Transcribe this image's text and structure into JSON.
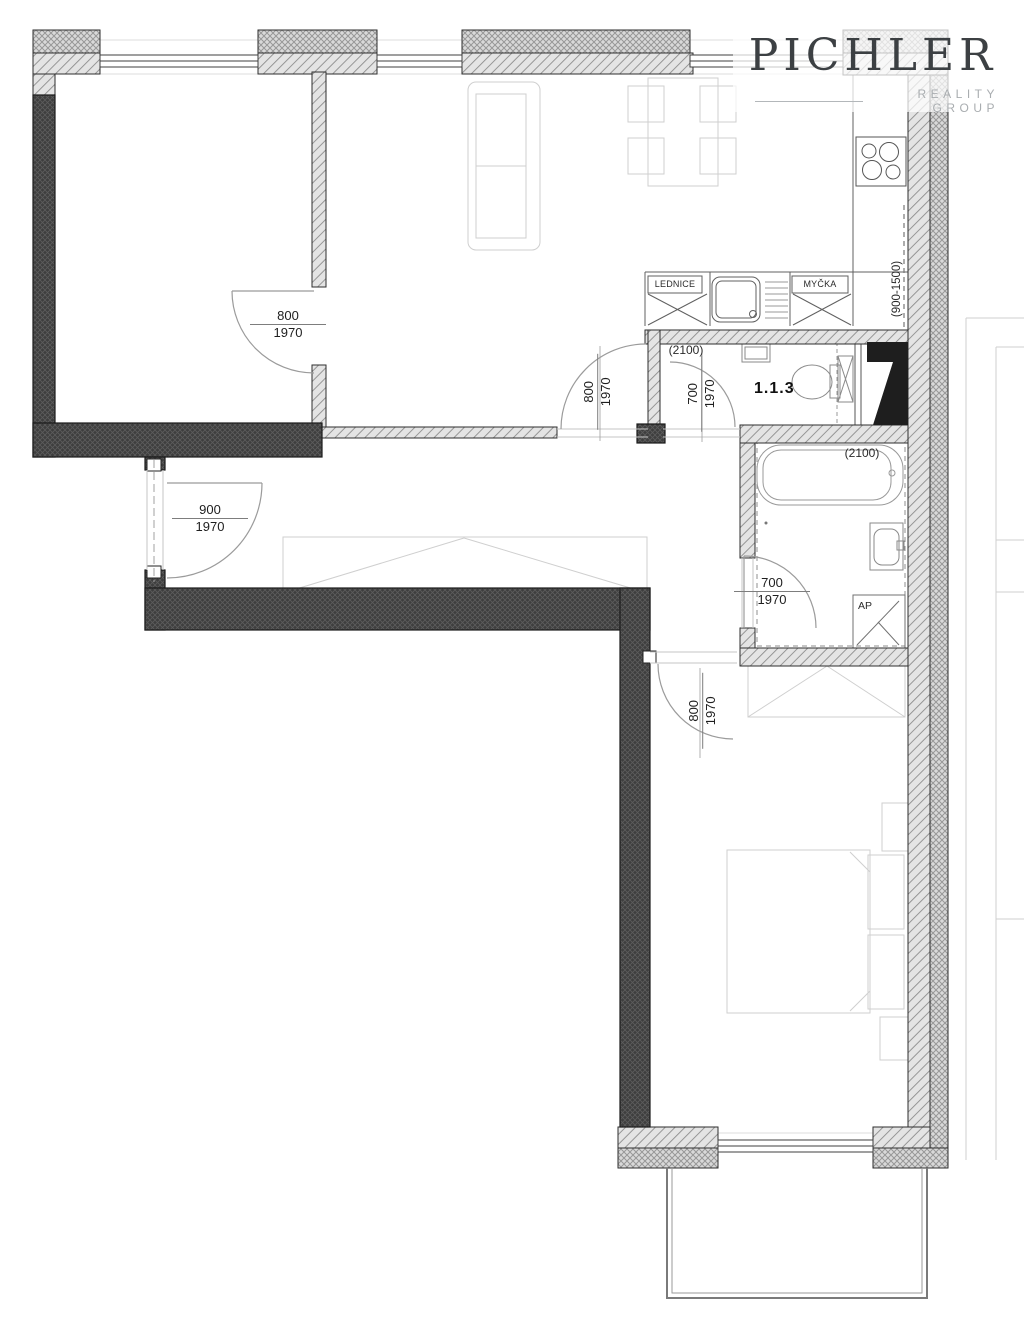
{
  "logo": {
    "brand": "PICHLER",
    "subtitle": "REALITY GROUP"
  },
  "unit": {
    "room_number": "1.1.3"
  },
  "annotations": {
    "fridge": "LEDNICE",
    "dishwasher": "MYČKA",
    "washing_machine": "AP",
    "wc_ceiling_height": "(2100)",
    "bathroom_ceiling_height": "(2100)",
    "kitchen_window_parapet": "(900-1500)"
  },
  "doors": {
    "bedroom1": {
      "width": "800",
      "height": "1970"
    },
    "entrance": {
      "width": "900",
      "height": "1970"
    },
    "living_room": {
      "width": "800",
      "height": "1970"
    },
    "wc": {
      "width": "700",
      "height": "1970"
    },
    "bathroom": {
      "width": "700",
      "height": "1970"
    },
    "bedroom2": {
      "width": "800",
      "height": "1970"
    }
  }
}
